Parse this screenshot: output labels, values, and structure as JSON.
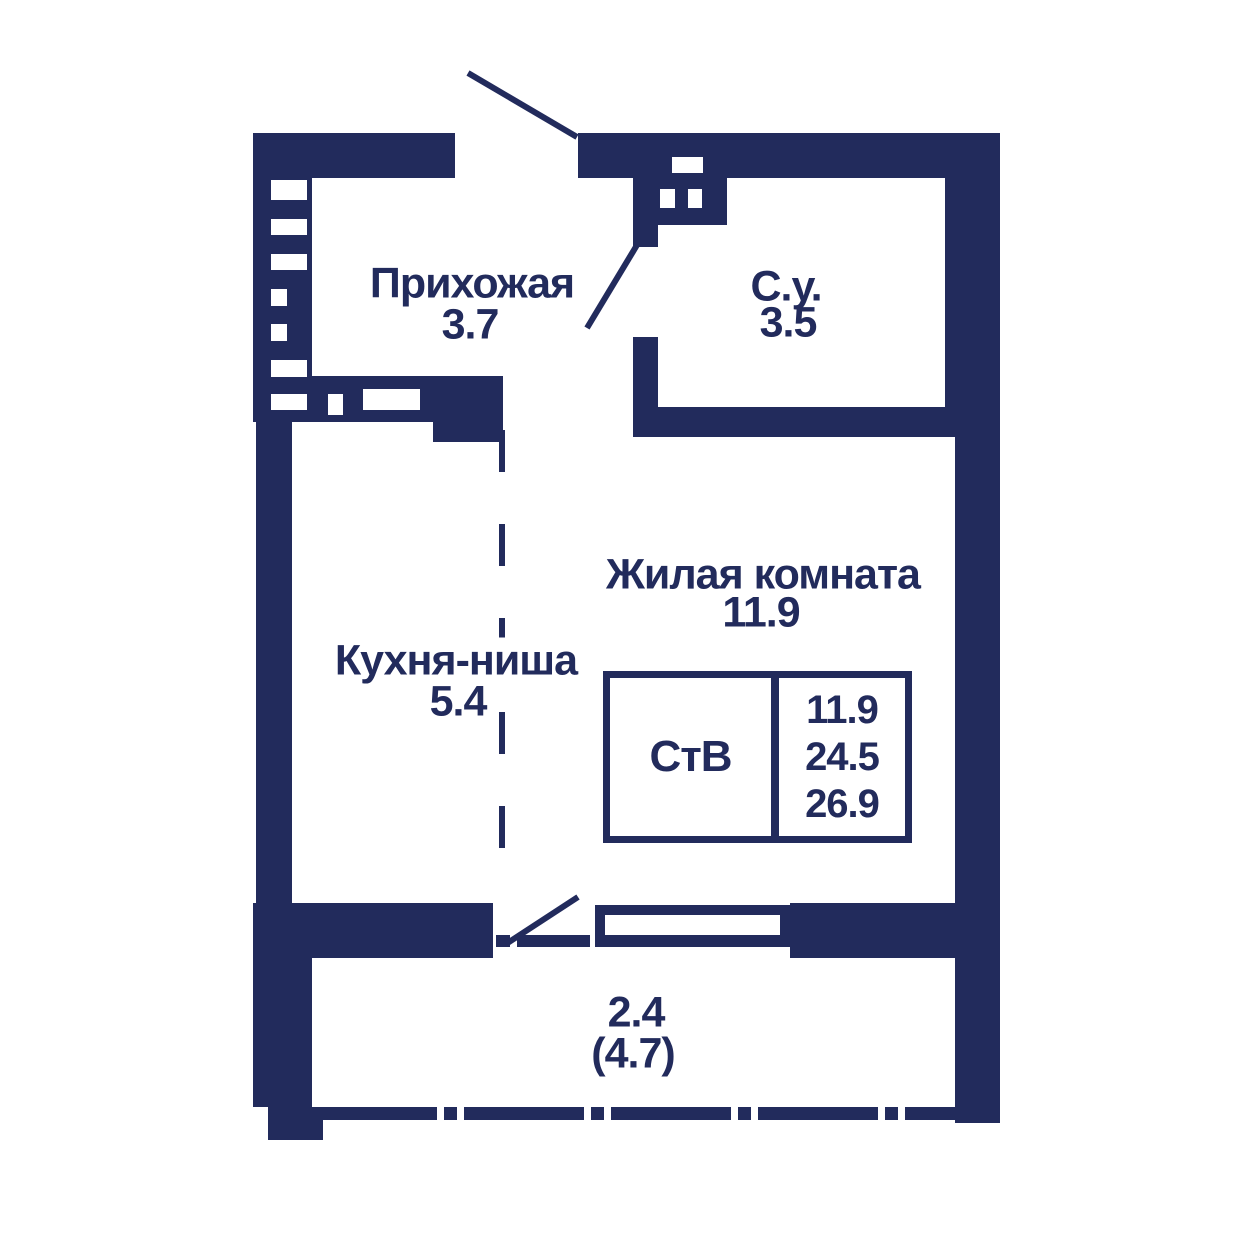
{
  "plan": {
    "wall_color": "#222b5c",
    "bg_color": "#ffffff",
    "rooms": {
      "hallway": {
        "name": "Прихожая",
        "area": "3.7"
      },
      "bathroom": {
        "name": "С.у.",
        "area": "3.5"
      },
      "living_room": {
        "name": "Жилая комната",
        "area": "11.9"
      },
      "kitchen_niche": {
        "name": "Кухня-ниша",
        "area": "5.4"
      },
      "balcony": {
        "area": "2.4",
        "area_total": "(4.7)"
      }
    },
    "info_box": {
      "type_label": "СтВ",
      "rows": [
        "11.9",
        "24.5",
        "26.9"
      ]
    }
  }
}
